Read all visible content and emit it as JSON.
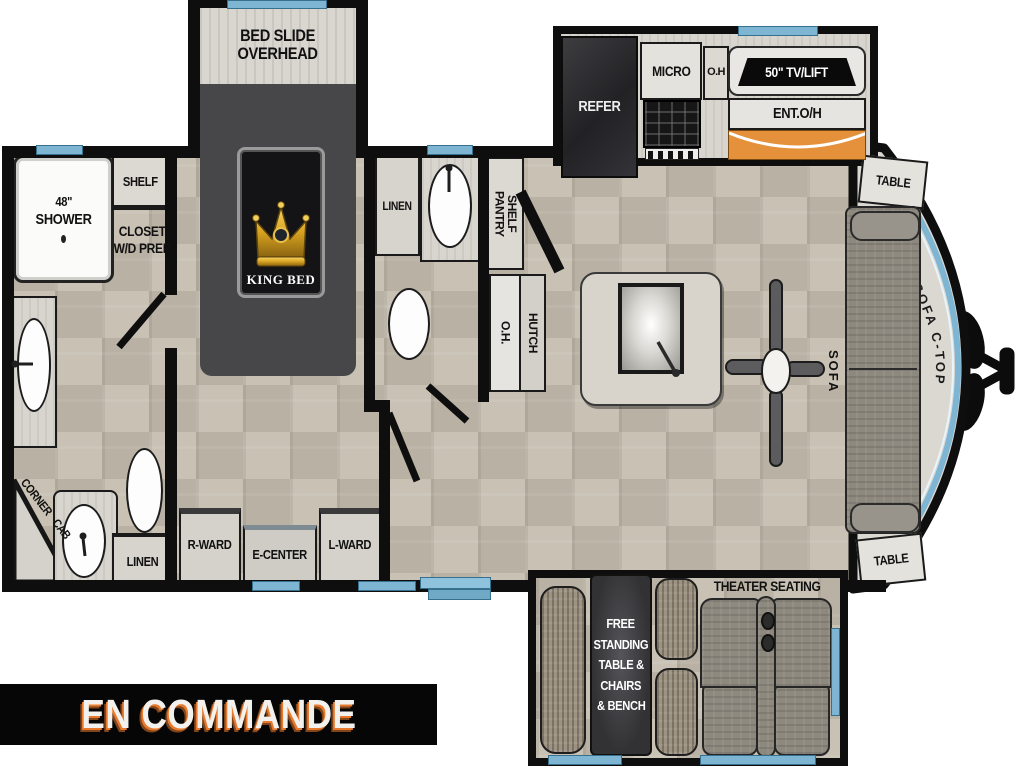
{
  "banner": {
    "label": "EN COMMANDE"
  },
  "colors": {
    "wall": "#0e0e0e",
    "window_blue": "#7db5d2",
    "counter_orange": "#e5913b",
    "banner_text": "#f3f1ee",
    "banner_shadow": "#e87a2e",
    "bed_slide_dark": "#47474a",
    "floor_tile": "#c7c0b3"
  },
  "labels": {
    "bed_slide": [
      "BED SLIDE",
      "OVERHEAD"
    ],
    "king_bed": "KING BED",
    "shower_size": "48\"",
    "shower": "SHOWER",
    "shelf": "SHELF",
    "closet": [
      "CLOSET",
      "W/D PREP"
    ],
    "corner_cab": [
      "CORNER",
      "CAB"
    ],
    "linen_master": "LINEN",
    "linen_main": "LINEN",
    "r_ward": "R-WARD",
    "e_center": "E-CENTER",
    "l_ward": "L-WARD",
    "pantry": [
      "PANTRY",
      "SHELF"
    ],
    "pantry_oh": "O.H.",
    "hutch": "HUTCH",
    "refer": "REFER",
    "micro": "MICRO",
    "kitchen_oh": "O.H",
    "tv_lift": "50\" TV/LIFT",
    "ent_oh": "ENT.O/H",
    "table_top": "TABLE",
    "table_bottom": "TABLE",
    "sofa": "SOFA",
    "sofa_ctop": "SOFA C-TOP",
    "free_standing": [
      "FREE",
      "STANDING",
      "TABLE &",
      "CHAIRS",
      "& BENCH"
    ],
    "theater": "THEATER SEATING"
  }
}
